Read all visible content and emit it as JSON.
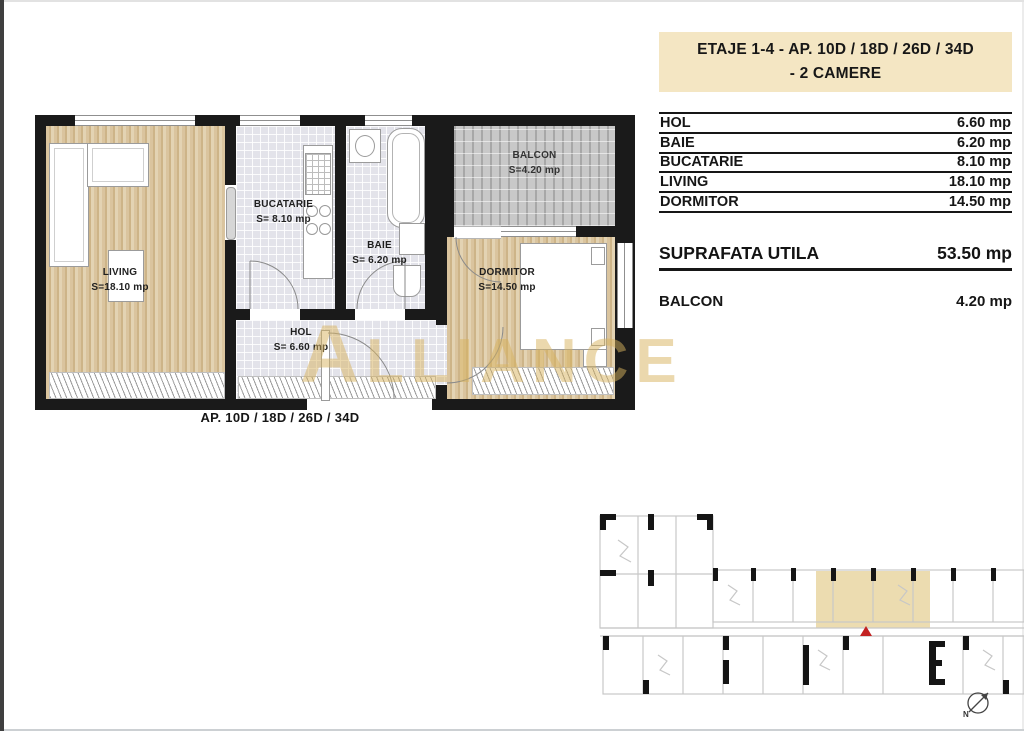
{
  "header": {
    "line1": "ETAJE 1-4 - AP. 10D / 18D / 26D / 34D",
    "line2": "- 2 CAMERE",
    "bg_color": "#f4e6c3"
  },
  "area_table": {
    "rows": [
      {
        "label": "HOL",
        "value": "6.60 mp"
      },
      {
        "label": "BAIE",
        "value": "6.20 mp"
      },
      {
        "label": "BUCATARIE",
        "value": "8.10 mp"
      },
      {
        "label": "LIVING",
        "value": "18.10 mp"
      },
      {
        "label": "DORMITOR",
        "value": "14.50 mp"
      }
    ],
    "total": {
      "label": "SUPRAFATA UTILA",
      "value": "53.50 mp"
    },
    "balcony": {
      "label": "BALCON",
      "value": "4.20 mp"
    }
  },
  "floor_plan": {
    "caption": "AP. 10D / 18D / 26D / 34D",
    "rooms": {
      "living": {
        "name": "LIVING",
        "area": "S=18.10 mp"
      },
      "bucatarie": {
        "name": "BUCATARIE",
        "area": "S= 8.10 mp"
      },
      "baie": {
        "name": "BAIE",
        "area": "S= 6.20 mp"
      },
      "hol": {
        "name": "HOL",
        "area": "S= 6.60 mp"
      },
      "dormitor": {
        "name": "DORMITOR",
        "area": "S=14.50 mp"
      },
      "balcon": {
        "name": "BALCON",
        "area": "S=4.20 mp"
      }
    }
  },
  "watermark": {
    "text": "ALLIANCE",
    "color": "#d8b35e"
  },
  "key_plan": {
    "compass_label": "N",
    "highlight_color": "#ecdcb0",
    "marker_color": "#c32222"
  },
  "colors": {
    "wall": "#1a1a1a",
    "wood_floor": "#d8c29a",
    "tile_floor": "#e3e3ea",
    "balcony_floor": "#c8c8c8"
  }
}
